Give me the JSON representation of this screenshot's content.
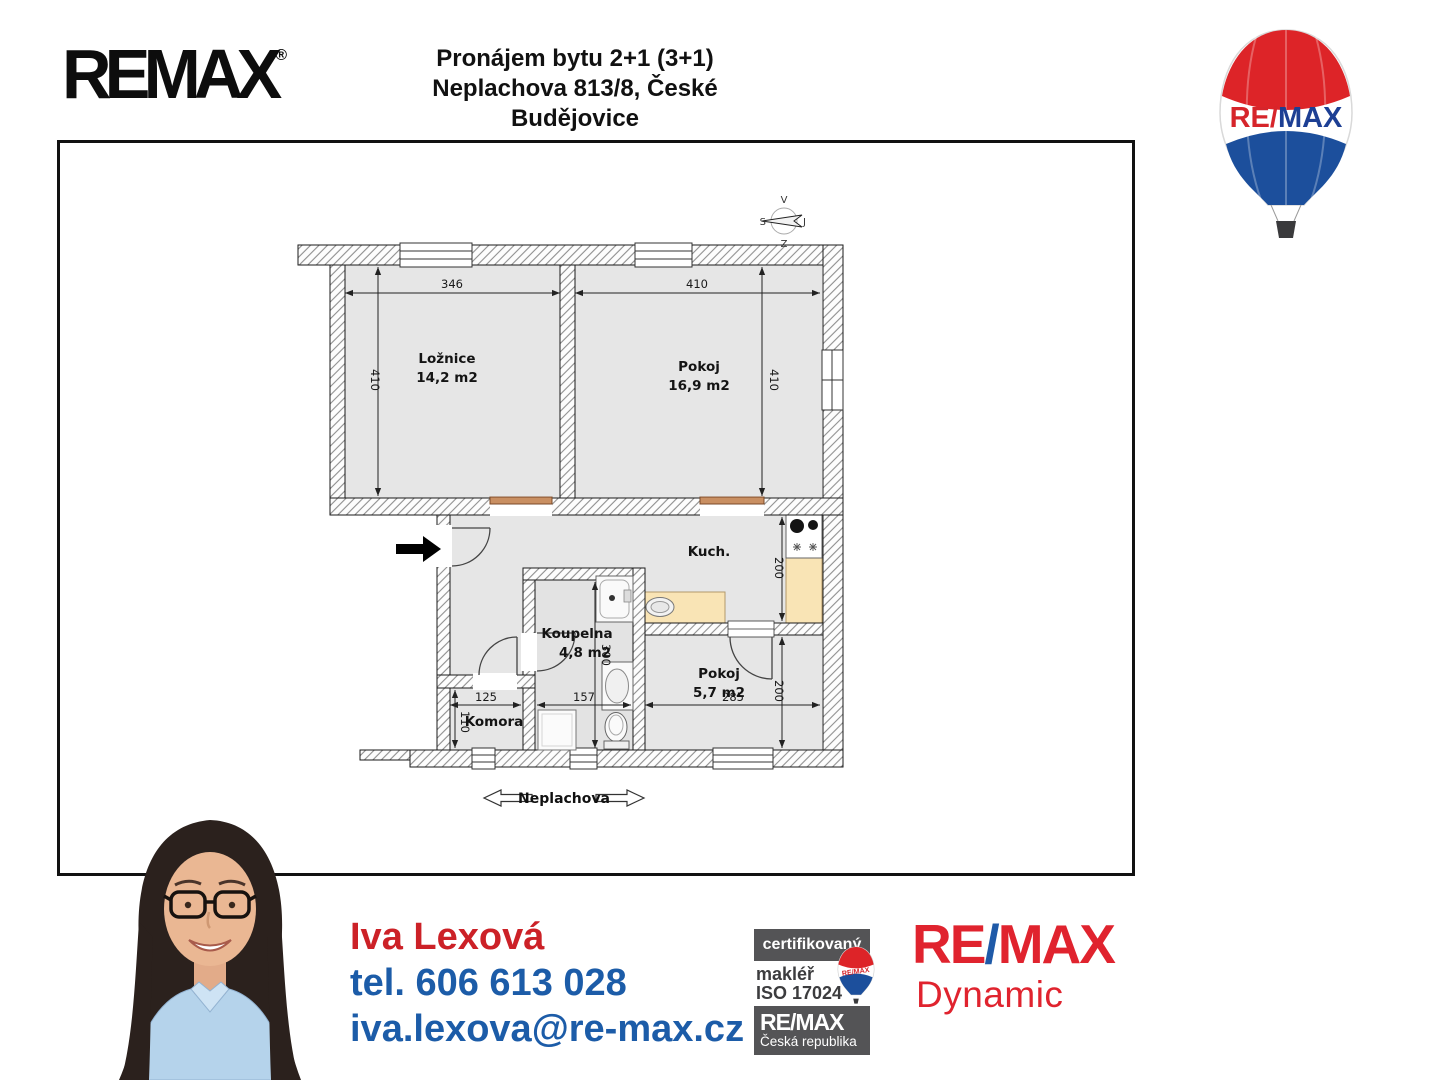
{
  "header": {
    "logo": "REMAX",
    "reg": "®",
    "title_line1": "Pronájem bytu 2+1 (3+1)",
    "title_line2": "Neplachova 813/8, České Budějovice"
  },
  "balloon": {
    "re": "RE",
    "slash": "/",
    "max": "MAX"
  },
  "plan": {
    "compass": {
      "top": "V",
      "left": "S",
      "right": "J",
      "bottom": "Z"
    },
    "rooms": {
      "loznice": {
        "name": "Ložnice",
        "area": "14,2 m2",
        "width": "346",
        "height": "410"
      },
      "pokoj1": {
        "name": "Pokoj",
        "area": "16,9 m2",
        "width": "410",
        "height": "410"
      },
      "kuchyn": {
        "name": "Kuch.",
        "height": "200"
      },
      "koupelna": {
        "name": "Koupelna",
        "area": "4,8 m2",
        "width": "157",
        "height": "300"
      },
      "pokoj2": {
        "name": "Pokoj",
        "area": "5,7 m2",
        "width": "285",
        "height": "200"
      },
      "komora": {
        "name": "Komora",
        "width": "125",
        "height": "110"
      }
    },
    "street": "Neplachova"
  },
  "contact": {
    "name": "Iva Lexová",
    "phone": "tel. 606 613 028",
    "email": "iva.lexova@re-max.cz"
  },
  "cert": {
    "line1": "certifikovaný",
    "line2": "makléř",
    "line3": "ISO 17024",
    "balloon_label": "RE/MAX",
    "brand": "RE/MAX",
    "country": "Česká republika"
  },
  "office": {
    "re": "RE",
    "slash": "/",
    "max": "MAX",
    "name": "Dynamic"
  },
  "colors": {
    "brand_red": "#e0232e",
    "brand_blue": "#1f5aa8",
    "contact_red": "#cc2127",
    "contact_blue": "#1c5ca8",
    "badge_gray": "#545456",
    "room_fill": "#e6e6e6",
    "counter_fill": "#f9e4b5",
    "sill_brown": "#c98f62"
  }
}
